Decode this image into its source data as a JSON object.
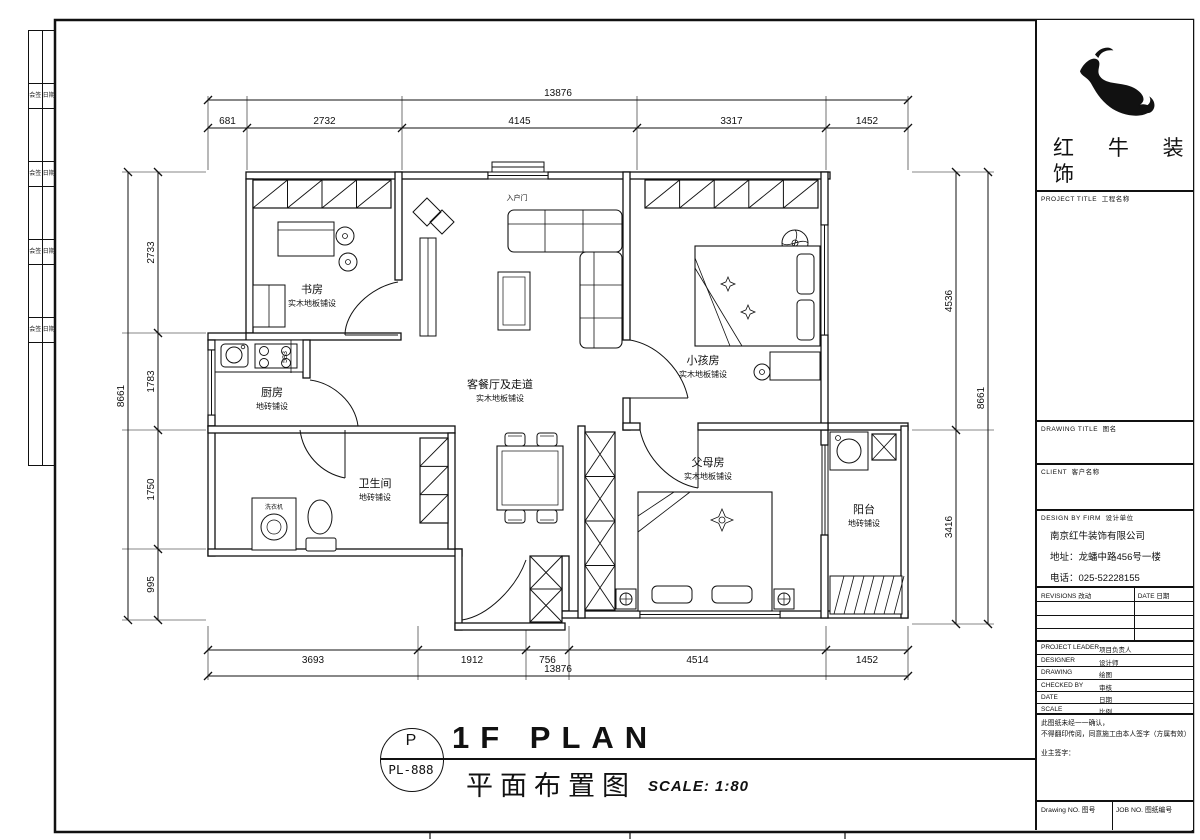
{
  "titlebar": {
    "tag_letter": "P",
    "tag_code": "PL-888",
    "title": "1F PLAN",
    "subtitle_cn": "平面布置图",
    "scale": "SCALE: 1:80"
  },
  "binding_strip": {
    "rows": [
      [
        "会签",
        "日期"
      ],
      [
        "会签",
        "日期"
      ],
      [
        "会签",
        "日期"
      ],
      [
        "会签",
        "日期"
      ]
    ]
  },
  "title_block": {
    "brand": {
      "line1": "红 牛 装",
      "line2": "饰"
    },
    "fields": [
      "PROJECT TITLE  工程名称",
      "DRAWING TITLE  图名",
      "CLIENT  客户名称",
      "DESIGN BY FIRM  设计单位"
    ],
    "company": [
      "南京红牛装饰有限公司",
      "地址：龙蟠中路456号一楼",
      "电话：025-52228155"
    ],
    "revisions": {
      "left": "REVISIONS  改动",
      "right": "DATE  日期"
    },
    "info_rows": [
      {
        "en": "PROJECT LEADER",
        "cn": "项目负责人"
      },
      {
        "en": "DESIGNER",
        "cn": "设计师"
      },
      {
        "en": "DRAWING",
        "cn": "绘图"
      },
      {
        "en": "CHECKED BY",
        "cn": "审核"
      },
      {
        "en": "DATE",
        "cn": "日期"
      },
      {
        "en": "SCALE",
        "cn": "比例"
      }
    ],
    "notes": [
      "此图纸未经一一确认，",
      "不得翻印传阅，同意施工由本人签字（方属有效）",
      "业主签字："
    ],
    "footer": {
      "left": "Drawing NO.  图号",
      "right": "JOB NO.  图纸编号"
    }
  },
  "plan": {
    "rooms": [
      {
        "name": "书房",
        "finish": "实木地板铺设",
        "x": 312,
        "y": 293
      },
      {
        "name": "厨房",
        "finish": "地砖铺设",
        "x": 272,
        "y": 396
      },
      {
        "name": "卫生间",
        "finish": "地砖铺设",
        "x": 375,
        "y": 487
      },
      {
        "name": "客餐厅及走道",
        "finish": "实木地板铺设",
        "x": 500,
        "y": 388
      },
      {
        "name": "小孩房",
        "finish": "实木地板铺设",
        "x": 703,
        "y": 364
      },
      {
        "name": "父母房",
        "finish": "实木地板铺设",
        "x": 708,
        "y": 466
      },
      {
        "name": "阳台",
        "finish": "地砖铺设",
        "x": 864,
        "y": 513
      }
    ],
    "annotations": [
      {
        "text": "入户门",
        "x": 517,
        "y": 200,
        "size": 7,
        "rot": 0
      },
      {
        "text": "583",
        "x": 287,
        "y": 357,
        "size": 7,
        "rot": -90
      },
      {
        "text": "洗衣机",
        "x": 274,
        "y": 509,
        "size": 6,
        "rot": 0
      }
    ],
    "dims": {
      "top_total": "13876",
      "top_segments": [
        "681",
        "2732",
        "4145",
        "3317",
        "1452"
      ],
      "bottom_segments": [
        "3693",
        "1912",
        "756",
        "4514",
        "1452"
      ],
      "bottom_total": "13876",
      "left_total": "8661",
      "left_segments": [
        "2733",
        "1783",
        "1750",
        "995"
      ],
      "right_segments": [
        "4536",
        "3416"
      ],
      "right_total": "8661"
    }
  }
}
